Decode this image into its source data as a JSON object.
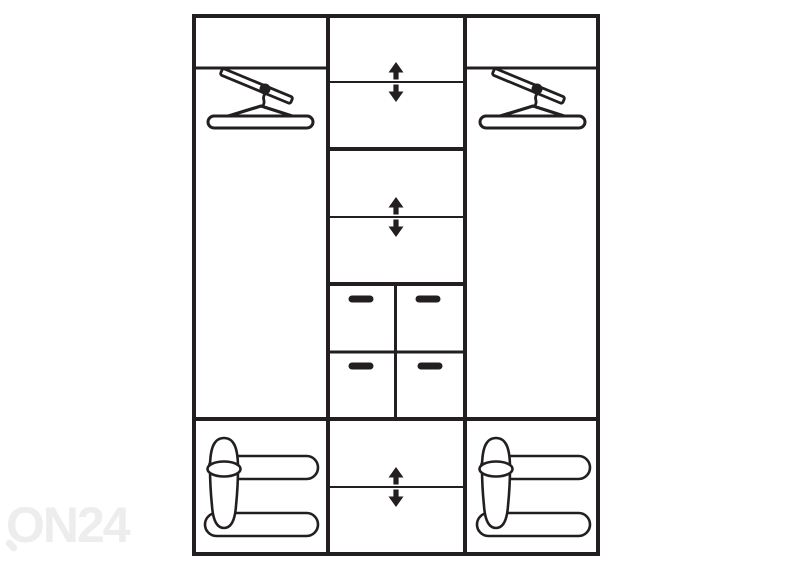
{
  "watermark": {
    "text": "ON24",
    "color": "#ededed"
  },
  "colors": {
    "line": "#231f20",
    "background": "#ffffff"
  },
  "icons": {
    "hanger_rail": "hanger-rail-icon",
    "adjustable_shelf": "adjustable-arrows-icon",
    "drawer_handle": "drawer-handle-icon",
    "shoe_rack": "shoe-rack-icon",
    "magnifier_tail": "magnifier-tail-icon"
  },
  "wardrobe": {
    "sections": [
      {
        "name": "left",
        "top_shelf": 1,
        "hanger_rails": 1,
        "shoe_racks": 1
      },
      {
        "name": "middle",
        "adjustable_shelves": 3,
        "fixed_shelves": 2,
        "drawers": 4
      },
      {
        "name": "right",
        "top_shelf": 1,
        "hanger_rails": 1,
        "shoe_racks": 1
      }
    ],
    "totals": {
      "drawers": 4,
      "adjustable_shelves": 3,
      "hanger_rails": 2,
      "shoe_racks": 2
    }
  }
}
